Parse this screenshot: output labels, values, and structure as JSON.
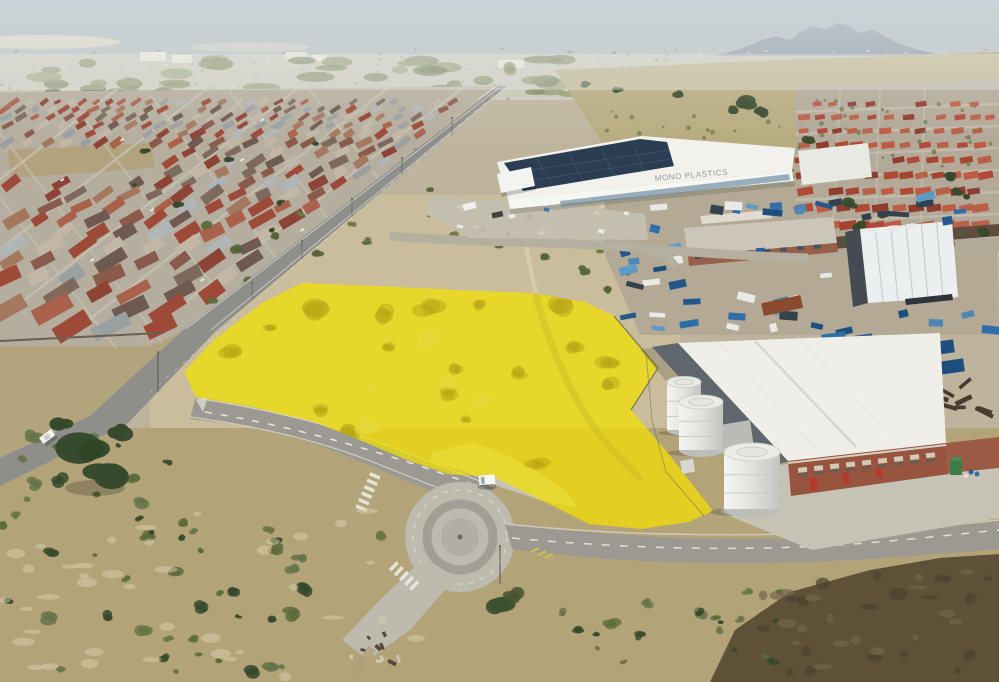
{
  "meta": {
    "type": "aerial-photograph",
    "description": "Aerial drone photo of a vacant land parcel highlighted in yellow, bordered by a diagonal main road, a traffic roundabout, industrial yards with blue plant equipment, a white solar-roofed warehouse, a white factory with silver storage tanks, township housing and open veld"
  },
  "highlight": {
    "color": "#F4E000",
    "opacity": 0.72
  },
  "warehouse": {
    "logo": "MONO PLASTICS"
  },
  "colors": {
    "sky_top": "#a7b4bd",
    "sky_horizon": "#d6d8d2",
    "mountain": "#93a0ac",
    "city_band": "#c9c5b7",
    "veld": "#b7ab80",
    "sand": "#c9bd9b",
    "scrub": "#b2a379",
    "verge": "#b2a57e",
    "burnt": "#5e5138",
    "asphalt": "#8e8e8a",
    "asphalt_light": "#9b9992",
    "concrete": "#bdbaae",
    "apron": "#c6c2b4",
    "ground_res_left": "#b5ae9f",
    "ground_res_right": "#b2a999",
    "ground_industrial": "#b3a995",
    "warehouse_roof": "#f2f1ec",
    "solar_panel": "#2b3d52",
    "glass": "#8fa5b5",
    "factory_roof": "#efeee8",
    "factory_wall_dark": "#5f666d",
    "brick": "#97543f",
    "tent": "#eceff0",
    "tank_light": "#f2f2f0",
    "tank_dark": "#bdbdb9",
    "tree": "#36492c",
    "bush": "#67744a",
    "roof_palette": [
      "#9d4a39",
      "#8a5a4a",
      "#a9614c",
      "#7d6a5d",
      "#9aa0a2",
      "#c2b7a6",
      "#6e5a50",
      "#a3785f",
      "#b0b6b8",
      "#8d4436"
    ],
    "roof_palette_right": [
      "#b04a36",
      "#a54531",
      "#c05a42",
      "#8f3d2e",
      "#b86048"
    ],
    "blue_palette": [
      "#2f6ea6",
      "#24578a",
      "#4f86b4",
      "#1d4f7e",
      "#5d9ac4",
      "#35424d",
      "#e9e9e7"
    ],
    "noise_palette": [
      "#cdc9bd",
      "#b9b4a6",
      "#a79f90",
      "#ded9cd",
      "#9d9588"
    ]
  }
}
